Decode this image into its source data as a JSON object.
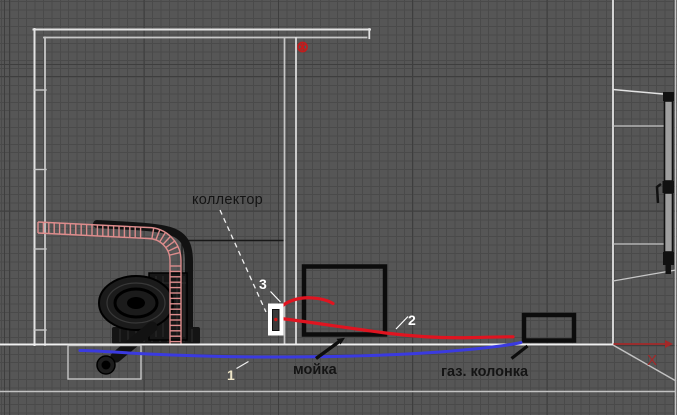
{
  "viewport": {
    "annotations": {
      "collector_label": "коллектор",
      "sink_label": "мойка",
      "gas_heater_label": "газ. колонка",
      "pipe_1_label": "1",
      "pipe_2_label": "2",
      "pipe_3_label": "3"
    },
    "axis_gizmo": {
      "x_label": "X"
    },
    "colors": {
      "background": "#565656",
      "grid_minor": "#4a4a4a",
      "grid_major": "#3e3e3e",
      "wall_line": "#e3e3e3",
      "wall_line_dim": "#c7c7c7",
      "floor_line": "#f0f0f0",
      "floor_line_secondary": "#c2c2c2",
      "cold_pipe_blue": "#3a3ae0",
      "hot_pipe_red": "#e01420",
      "corrugated_pipe_pink": "#dd8c8c",
      "fixture_outline_black": "#0c0c0c",
      "label_dark": "#141414",
      "label_white": "#ffffff",
      "label_cream": "#efe6c8",
      "axis_red": "#a32828",
      "vent_marker_red": "#c41c1c",
      "window_glass_gray": "#9f9f9f"
    }
  }
}
